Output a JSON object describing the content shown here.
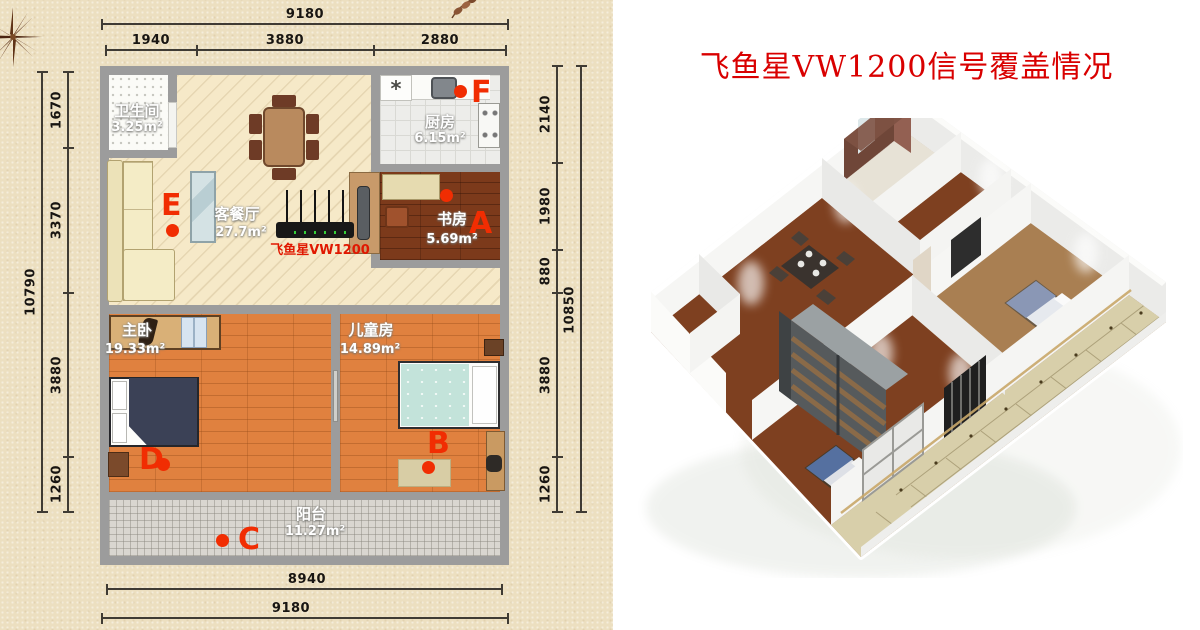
{
  "title": "飞鱼星VW1200信号覆盖情况",
  "floor_plan": {
    "rooms": {
      "bathroom": {
        "name": "卫生间",
        "area": "3.25m²"
      },
      "kitchen": {
        "name": "厨房",
        "area": "6.15m²"
      },
      "living": {
        "name": "客餐厅",
        "area": "27.7m²"
      },
      "study": {
        "name": "书房",
        "area": "5.69m²"
      },
      "master": {
        "name": "主卧",
        "area": "19.33m²"
      },
      "kids": {
        "name": "儿童房",
        "area": "14.89m²"
      },
      "balcony": {
        "name": "阳台",
        "area": "11.27m²"
      }
    },
    "router_label": "飞鱼星VW1200",
    "kitchen_symbol": "*",
    "markers": {
      "a": "A",
      "b": "B",
      "c": "C",
      "d": "D",
      "e": "E",
      "f": "F"
    },
    "dimensions": {
      "top_total": "9180",
      "top_seg1": "1940",
      "top_seg2": "3880",
      "top_seg3": "2880",
      "left_total": "10790",
      "left_seg1": "1670",
      "left_seg2": "3370",
      "left_seg3": "3880",
      "left_seg4": "1260",
      "right_total": "10850",
      "right_seg1": "2140",
      "right_seg2": "1980",
      "right_seg3": "880",
      "right_seg4": "3880",
      "right_seg5": "1260",
      "bottom_inner": "8940",
      "bottom_outer": "9180"
    },
    "colors": {
      "marker": "#f12d02",
      "title": "#d90000",
      "wall": "#9c9c9c"
    }
  }
}
